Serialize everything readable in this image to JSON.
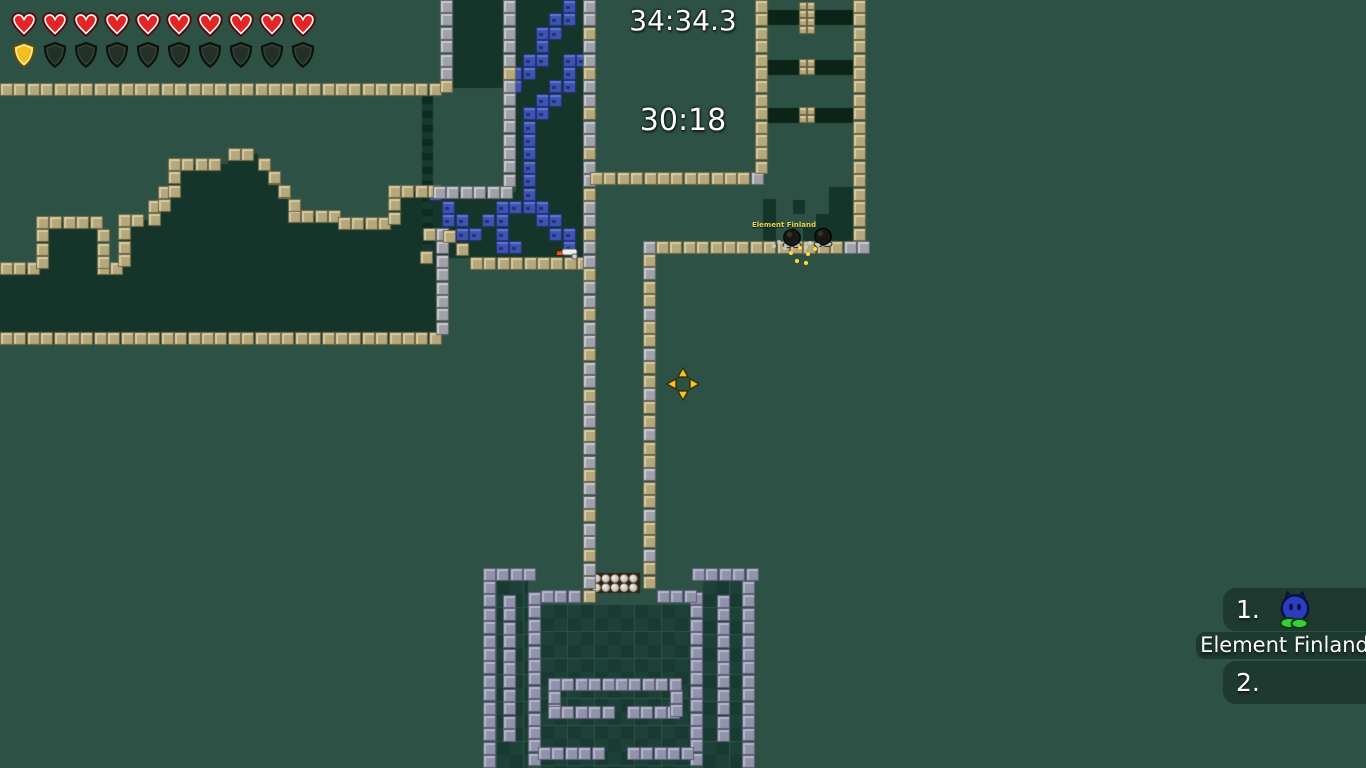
{
  "hud": {
    "health": {
      "filled": 10,
      "total": 10
    },
    "armor": {
      "filled": 1,
      "total": 10
    }
  },
  "timers": {
    "game_time": "34:34.3",
    "race_time": "30:18"
  },
  "nameplate": {
    "text": "Element Finland"
  },
  "scoreboard": {
    "entries": [
      {
        "rank": "1.",
        "name": "Element Finland"
      },
      {
        "rank": "2.",
        "name": ""
      }
    ]
  },
  "cursor": {
    "x": 683,
    "y": 384
  },
  "tees": [
    {
      "x": 781,
      "y": 227
    },
    {
      "x": 812,
      "y": 226
    }
  ],
  "pickups": [
    {
      "type": "gun",
      "x": 556,
      "y": 245
    }
  ],
  "sparks_gold": [
    [
      789,
      251
    ],
    [
      798,
      246
    ],
    [
      806,
      252
    ],
    [
      813,
      247
    ],
    [
      795,
      259
    ],
    [
      804,
      261
    ]
  ],
  "sparks_grey": [
    [
      777,
      240
    ],
    [
      772,
      244
    ],
    [
      783,
      246
    ],
    [
      808,
      241
    ],
    [
      804,
      245
    ],
    [
      816,
      243
    ]
  ],
  "colors": {
    "bg": "#2d5144",
    "terrain": "#16352a",
    "bars": "#0c2418",
    "teal_a": "#0e2b22",
    "teal_b": "#17392f",
    "int_a": "#1d4038",
    "int_b": "#193a31",
    "pearl_bg": "#322018",
    "tan": {
      "base": "#b4a87c",
      "light": "#d8cda4",
      "dark": "#6e6546"
    },
    "grey": {
      "base": "#a0a2aa",
      "light": "#cacccf",
      "dark": "#63656d"
    },
    "purple": {
      "base": "#9193ab",
      "light": "#b6b8cc",
      "dark": "#5d5f78"
    },
    "blue": {
      "base": "#3d55ae",
      "light": "#5d79d4",
      "dark": "#22307a"
    }
  },
  "map": {
    "tile": 13.4,
    "mountain": {
      "base": 332,
      "right_edge": 437,
      "segments": [
        [
          0,
          36,
          262
        ],
        [
          36,
          97,
          216
        ],
        [
          97,
          118,
          262
        ],
        [
          118,
          148,
          214
        ],
        [
          148,
          158,
          200
        ],
        [
          158,
          168,
          186
        ],
        [
          168,
          228,
          158
        ],
        [
          228,
          258,
          148
        ],
        [
          258,
          268,
          158
        ],
        [
          268,
          278,
          172
        ],
        [
          278,
          288,
          186
        ],
        [
          288,
          338,
          210
        ],
        [
          338,
          388,
          217
        ],
        [
          388,
          437,
          185
        ]
      ]
    },
    "fills": [
      [
        453,
        0,
        50,
        88
      ],
      [
        516,
        0,
        67,
        192
      ],
      [
        433,
        192,
        150,
        66
      ],
      [
        763,
        199,
        13,
        43
      ],
      [
        793,
        200,
        12,
        14
      ],
      [
        803,
        228,
        13,
        14
      ],
      [
        816,
        214,
        13,
        28
      ],
      [
        829,
        187,
        24,
        55
      ],
      [
        842,
        192,
        11,
        50
      ]
    ],
    "teal": [
      422,
      90,
      11,
      158
    ],
    "interiors": [
      [
        497,
        581,
        31,
        187
      ],
      [
        541,
        605,
        149,
        163
      ],
      [
        703,
        581,
        39,
        187
      ]
    ],
    "bars": [
      [
        768,
        10,
        85,
        15
      ],
      [
        768,
        60,
        85,
        15
      ],
      [
        768,
        108,
        85,
        15
      ]
    ],
    "bar_blocks": [
      [
        799,
        2,
        16,
        26
      ],
      [
        799,
        59,
        16,
        17
      ],
      [
        799,
        107,
        16,
        17
      ]
    ],
    "blue_paths": [
      [
        [
          572,
          6
        ],
        [
          515,
          88
        ]
      ],
      [
        [
          578,
          62
        ],
        [
          524,
          132
        ]
      ],
      [
        [
          524,
          132
        ],
        [
          524,
          198
        ]
      ],
      [
        [
          436,
          196
        ],
        [
          466,
          238
        ]
      ],
      [
        [
          466,
          238
        ],
        [
          524,
          198
        ]
      ],
      [
        [
          524,
          198
        ],
        [
          572,
          246
        ]
      ],
      [
        [
          505,
          212
        ],
        [
          505,
          247
        ]
      ],
      [
        [
          505,
          247
        ],
        [
          519,
          247
        ]
      ]
    ],
    "pearls": {
      "x": 592,
      "y": 574,
      "cols": 5,
      "rows": 2,
      "cell": 9.2
    },
    "runs": [
      {
        "x": 0,
        "y": 83,
        "d": "h",
        "n": 33,
        "t": "tan"
      },
      {
        "x": 0,
        "y": 332,
        "d": "h",
        "n": 33,
        "t": "tan"
      },
      {
        "x": 440,
        "y": 0,
        "d": "v",
        "n": 6,
        "t": "grey"
      },
      {
        "x": 440,
        "y": 80,
        "d": "v",
        "n": 1,
        "t": "tan"
      },
      {
        "x": 503,
        "y": 0,
        "d": "v",
        "n": 5,
        "t": "grey"
      },
      {
        "x": 503,
        "y": 67,
        "d": "v",
        "n": 1,
        "t": "tan"
      },
      {
        "x": 503,
        "y": 80,
        "d": "v",
        "n": 8,
        "t": "grey"
      },
      {
        "x": 433,
        "y": 186,
        "d": "h",
        "n": 6,
        "t": "grey"
      },
      {
        "x": 423,
        "y": 228,
        "d": "v",
        "n": 1,
        "t": "tan"
      },
      {
        "x": 436,
        "y": 228,
        "d": "v",
        "n": 8,
        "t": "grey"
      },
      {
        "x": 443,
        "y": 230,
        "d": "v",
        "n": 1,
        "t": "tan"
      },
      {
        "x": 456,
        "y": 243,
        "d": "v",
        "n": 1,
        "t": "tan"
      },
      {
        "x": 420,
        "y": 251,
        "d": "h",
        "n": 1,
        "t": "tan"
      },
      {
        "x": 470,
        "y": 257,
        "d": "h",
        "n": 9,
        "t": "tan"
      },
      {
        "x": 583,
        "y": 0,
        "d": "v",
        "n": 45,
        "t": "mixed"
      },
      {
        "x": 590,
        "y": 172,
        "d": "h",
        "n": 12,
        "t": "tan"
      },
      {
        "x": 751,
        "y": 172,
        "d": "h",
        "n": 1,
        "t": "grey"
      },
      {
        "x": 755,
        "y": 0,
        "d": "v",
        "n": 13,
        "t": "tan"
      },
      {
        "x": 853,
        "y": 0,
        "d": "v",
        "n": 18,
        "t": "tan"
      },
      {
        "x": 643,
        "y": 241,
        "d": "h",
        "n": 1,
        "t": "grey"
      },
      {
        "x": 656,
        "y": 241,
        "d": "h",
        "n": 14,
        "t": "tan"
      },
      {
        "x": 844,
        "y": 241,
        "d": "h",
        "n": 2,
        "t": "grey"
      },
      {
        "x": 643,
        "y": 254,
        "d": "v",
        "n": 25,
        "t": "mixed"
      },
      {
        "x": 483,
        "y": 568,
        "d": "h",
        "n": 4,
        "t": "purple"
      },
      {
        "x": 692,
        "y": 568,
        "d": "h",
        "n": 5,
        "t": "purple"
      },
      {
        "x": 483,
        "y": 581,
        "d": "v",
        "n": 14,
        "t": "purple"
      },
      {
        "x": 742,
        "y": 581,
        "d": "v",
        "n": 14,
        "t": "purple"
      },
      {
        "x": 503,
        "y": 595,
        "d": "v",
        "n": 11,
        "t": "purple"
      },
      {
        "x": 717,
        "y": 595,
        "d": "v",
        "n": 11,
        "t": "purple"
      },
      {
        "x": 528,
        "y": 592,
        "d": "v",
        "n": 13,
        "t": "purple"
      },
      {
        "x": 690,
        "y": 592,
        "d": "v",
        "n": 13,
        "t": "purple"
      },
      {
        "x": 541,
        "y": 590,
        "d": "h",
        "n": 3,
        "t": "purple"
      },
      {
        "x": 657,
        "y": 590,
        "d": "h",
        "n": 3,
        "t": "purple"
      },
      {
        "x": 548,
        "y": 678,
        "d": "h",
        "n": 10,
        "t": "purple"
      },
      {
        "x": 548,
        "y": 691,
        "d": "v",
        "n": 2,
        "t": "purple"
      },
      {
        "x": 548,
        "y": 706,
        "d": "h",
        "n": 5,
        "t": "purple"
      },
      {
        "x": 627,
        "y": 706,
        "d": "h",
        "n": 4,
        "t": "purple"
      },
      {
        "x": 670,
        "y": 691,
        "d": "v",
        "n": 2,
        "t": "purple"
      },
      {
        "x": 538,
        "y": 747,
        "d": "h",
        "n": 5,
        "t": "purple"
      },
      {
        "x": 627,
        "y": 747,
        "d": "h",
        "n": 5,
        "t": "purple"
      }
    ]
  }
}
